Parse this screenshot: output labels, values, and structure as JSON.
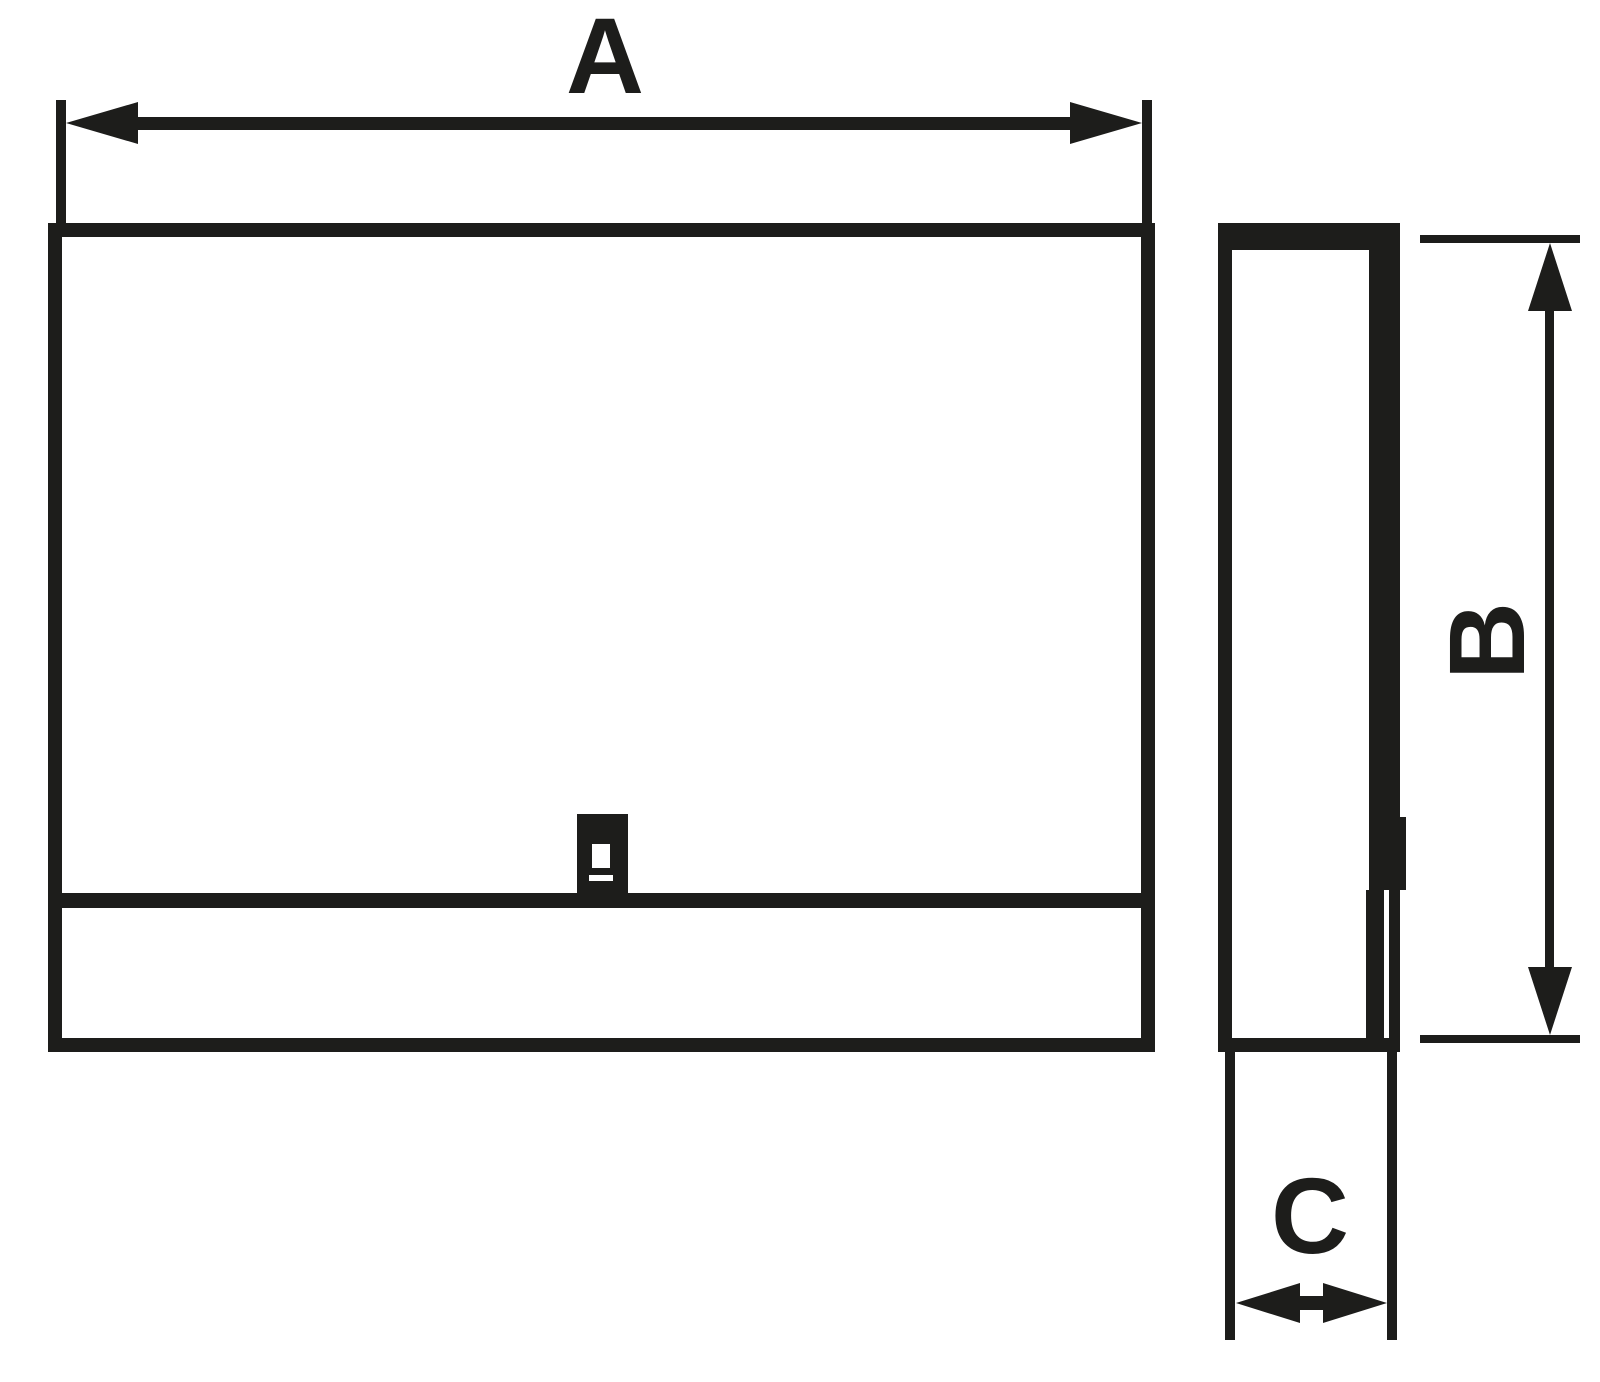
{
  "colors": {
    "ink": "#1d1d1b",
    "background": "#ffffff"
  },
  "dimensions": {
    "width": {
      "label": "A"
    },
    "height": {
      "label": "B"
    },
    "depth": {
      "label": "C"
    }
  }
}
